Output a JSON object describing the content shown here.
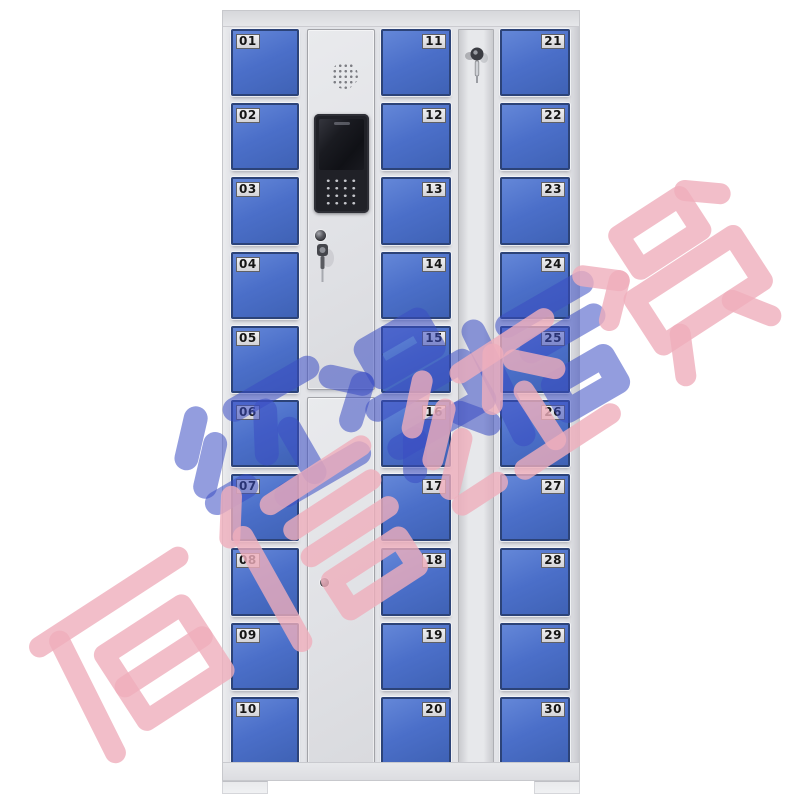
{
  "scene": {
    "background_color": "#ffffff",
    "subject": "30-door blue storage locker cabinet with central control panel"
  },
  "cabinet": {
    "door_numbers": {
      "left": [
        "01",
        "02",
        "03",
        "04",
        "05",
        "06",
        "07",
        "08",
        "09",
        "10"
      ],
      "middle": [
        "11",
        "12",
        "13",
        "14",
        "15",
        "16",
        "17",
        "18",
        "19",
        "20"
      ],
      "right": [
        "21",
        "22",
        "23",
        "24",
        "25",
        "26",
        "27",
        "28",
        "29",
        "30"
      ]
    },
    "label_side": {
      "left": "left",
      "middle": "right",
      "right": "right"
    },
    "control_panel": {
      "components": [
        "speaker-grille",
        "display-screen",
        "numeric-keypad",
        "key-lock",
        "hanging-keys",
        "lower-door-lock"
      ]
    },
    "lock_strip": {
      "components": [
        "key-lock",
        "inserted-key"
      ]
    },
    "colors": {
      "door_blue": "#4b6fc9",
      "door_border": "#2c4378",
      "frame_gray": "#e3e4e8",
      "label_bg": "#e2e2e5",
      "number_text": "#151515",
      "module_black": "#202127"
    }
  },
  "watermark": {
    "text": "佰信经贸",
    "pink_color": "#efaebb",
    "blue_color": "#3a4dc2",
    "rotation_deg": -32
  }
}
